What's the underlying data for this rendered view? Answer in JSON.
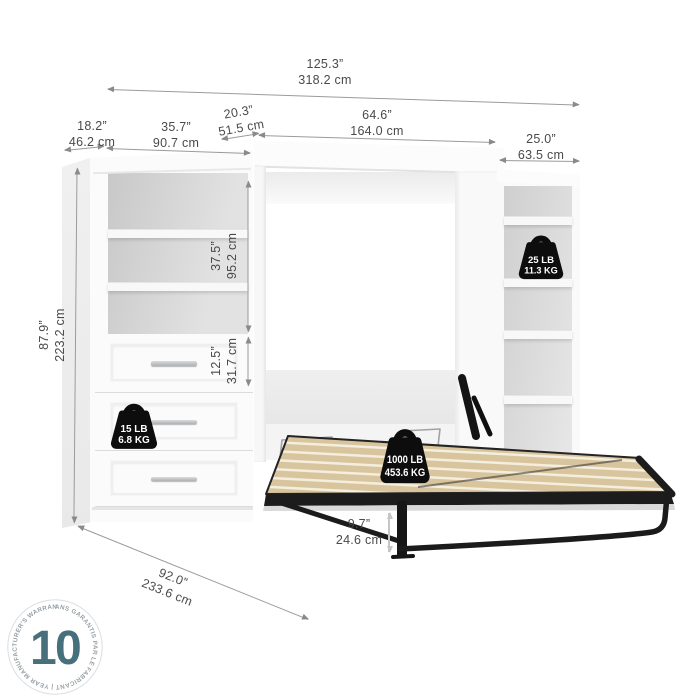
{
  "dims": {
    "overall_width": {
      "in": "125.3”",
      "cm": "318.2 cm"
    },
    "left_unit_depth": {
      "in": "18.2”",
      "cm": "46.2 cm"
    },
    "left_unit_width": {
      "in": "35.7”",
      "cm": "90.7 cm"
    },
    "bed_cabinet_depth": {
      "in": "20.3”",
      "cm": "51.5 cm"
    },
    "bed_width": {
      "in": "64.6”",
      "cm": "164.0 cm"
    },
    "right_unit_width": {
      "in": "25.0”",
      "cm": "63.5 cm"
    },
    "overall_height": {
      "in": "87.9”",
      "cm": "223.2 cm"
    },
    "shelf_section_height": {
      "in": "37.5”",
      "cm": "95.2 cm"
    },
    "drawer_height": {
      "in": "12.5”",
      "cm": "31.7 cm"
    },
    "bed_frame_height": {
      "in": "9.7”",
      "cm": "24.6 cm"
    },
    "open_depth": {
      "in": "92.0”",
      "cm": "233.6 cm"
    }
  },
  "weights": {
    "drawer": {
      "lb": "15 LB",
      "kg": "6.8 KG"
    },
    "shelf": {
      "lb": "25 LB",
      "kg": "11.3 KG"
    },
    "bed": {
      "lb": "1000 LB",
      "kg": "453.6 KG"
    }
  },
  "warranty": {
    "years": "10",
    "ring_text": "ANS GARANTIS PAR LE FABRICANT   |   YEAR MANUFACTURER'S WARRANTY   |"
  },
  "colors": {
    "accent_teal": "#48707C",
    "slat_beige": "#D8C59D",
    "frame_black": "#1B1B1B",
    "dimension_gray": "#9B9B9B"
  }
}
